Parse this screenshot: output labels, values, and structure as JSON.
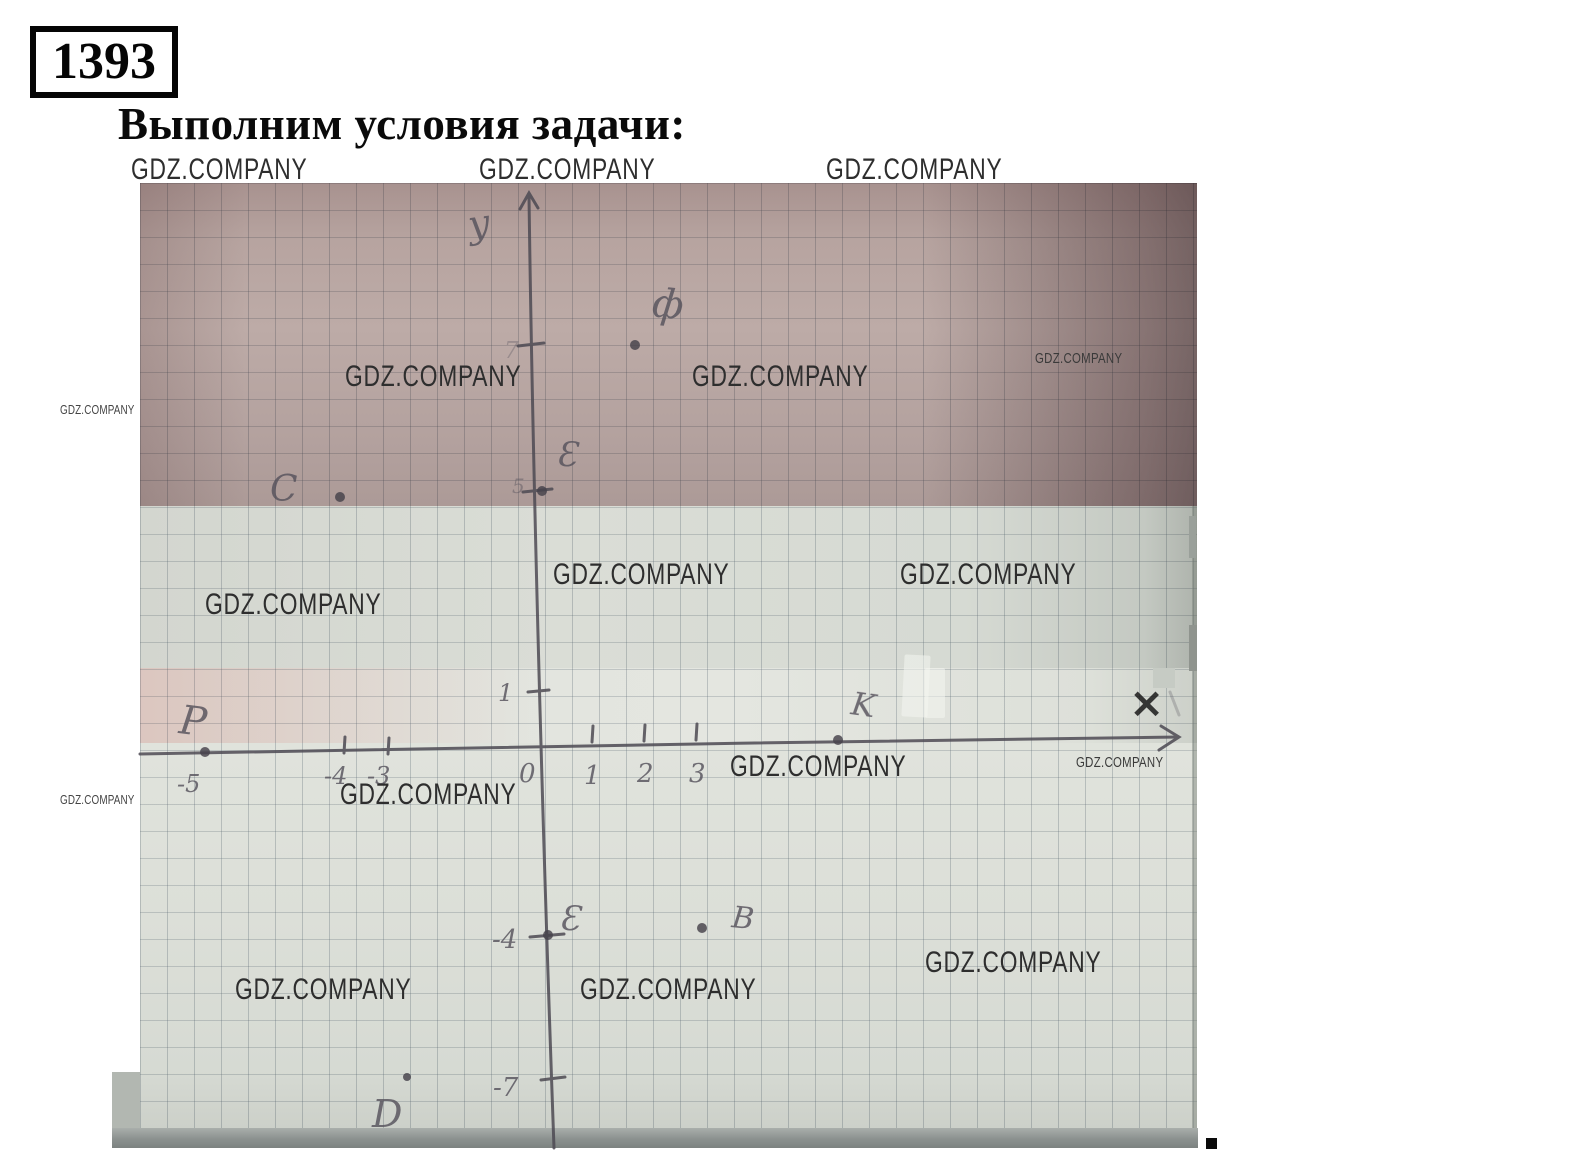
{
  "meta": {
    "problem_number": "1393",
    "title": "Выполним условия задачи:",
    "trailing_period": "."
  },
  "watermark": {
    "text": "GDZ.COMPANY"
  },
  "figure": {
    "description": "Photograph of a hand-drawn coordinate plane on squared notebook paper; pencil axes with arrows, tick labels and labelled points",
    "axes": {
      "x_label": "×",
      "y_label": "у"
    },
    "points": [
      {
        "label": "ф",
        "x": 2,
        "y": 7
      },
      {
        "label": "E",
        "x": 0,
        "y": 5
      },
      {
        "label": "C",
        "x": -3.5,
        "y": 2.5
      },
      {
        "label": "P",
        "x": -5,
        "y": 0
      },
      {
        "label": "K",
        "x": 5,
        "y": 0
      },
      {
        "label": "E",
        "x": 0,
        "y": -4
      },
      {
        "label": "B",
        "x": 3,
        "y": -4
      },
      {
        "label": "D",
        "x": -3,
        "y": -7
      }
    ],
    "hand_labels": [
      {
        "id": "y-axis-letter",
        "text": "у"
      },
      {
        "id": "point-label-f",
        "text": "ф"
      },
      {
        "id": "y-tick-7",
        "text": "7"
      },
      {
        "id": "y-tick-5",
        "text": "5"
      },
      {
        "id": "point-label-E-top",
        "text": "Ɛ"
      },
      {
        "id": "point-label-C",
        "text": "C"
      },
      {
        "id": "y-tick-1",
        "text": "1"
      },
      {
        "id": "point-label-P",
        "text": "P"
      },
      {
        "id": "x-tick-neg5",
        "text": "-5"
      },
      {
        "id": "x-tick-neg4",
        "text": "-4"
      },
      {
        "id": "x-tick-neg3",
        "text": "-3"
      },
      {
        "id": "origin-0",
        "text": "0"
      },
      {
        "id": "x-tick-1",
        "text": "1"
      },
      {
        "id": "x-tick-2",
        "text": "2"
      },
      {
        "id": "x-tick-3",
        "text": "3"
      },
      {
        "id": "point-label-K",
        "text": "K"
      },
      {
        "id": "y-tick-neg4",
        "text": "-4"
      },
      {
        "id": "point-label-E-bottom",
        "text": "Ɛ"
      },
      {
        "id": "point-label-B",
        "text": "B"
      },
      {
        "id": "y-tick-neg7",
        "text": "-7"
      },
      {
        "id": "point-label-D",
        "text": "D"
      },
      {
        "id": "x-axis-letter",
        "text": "×"
      }
    ]
  }
}
